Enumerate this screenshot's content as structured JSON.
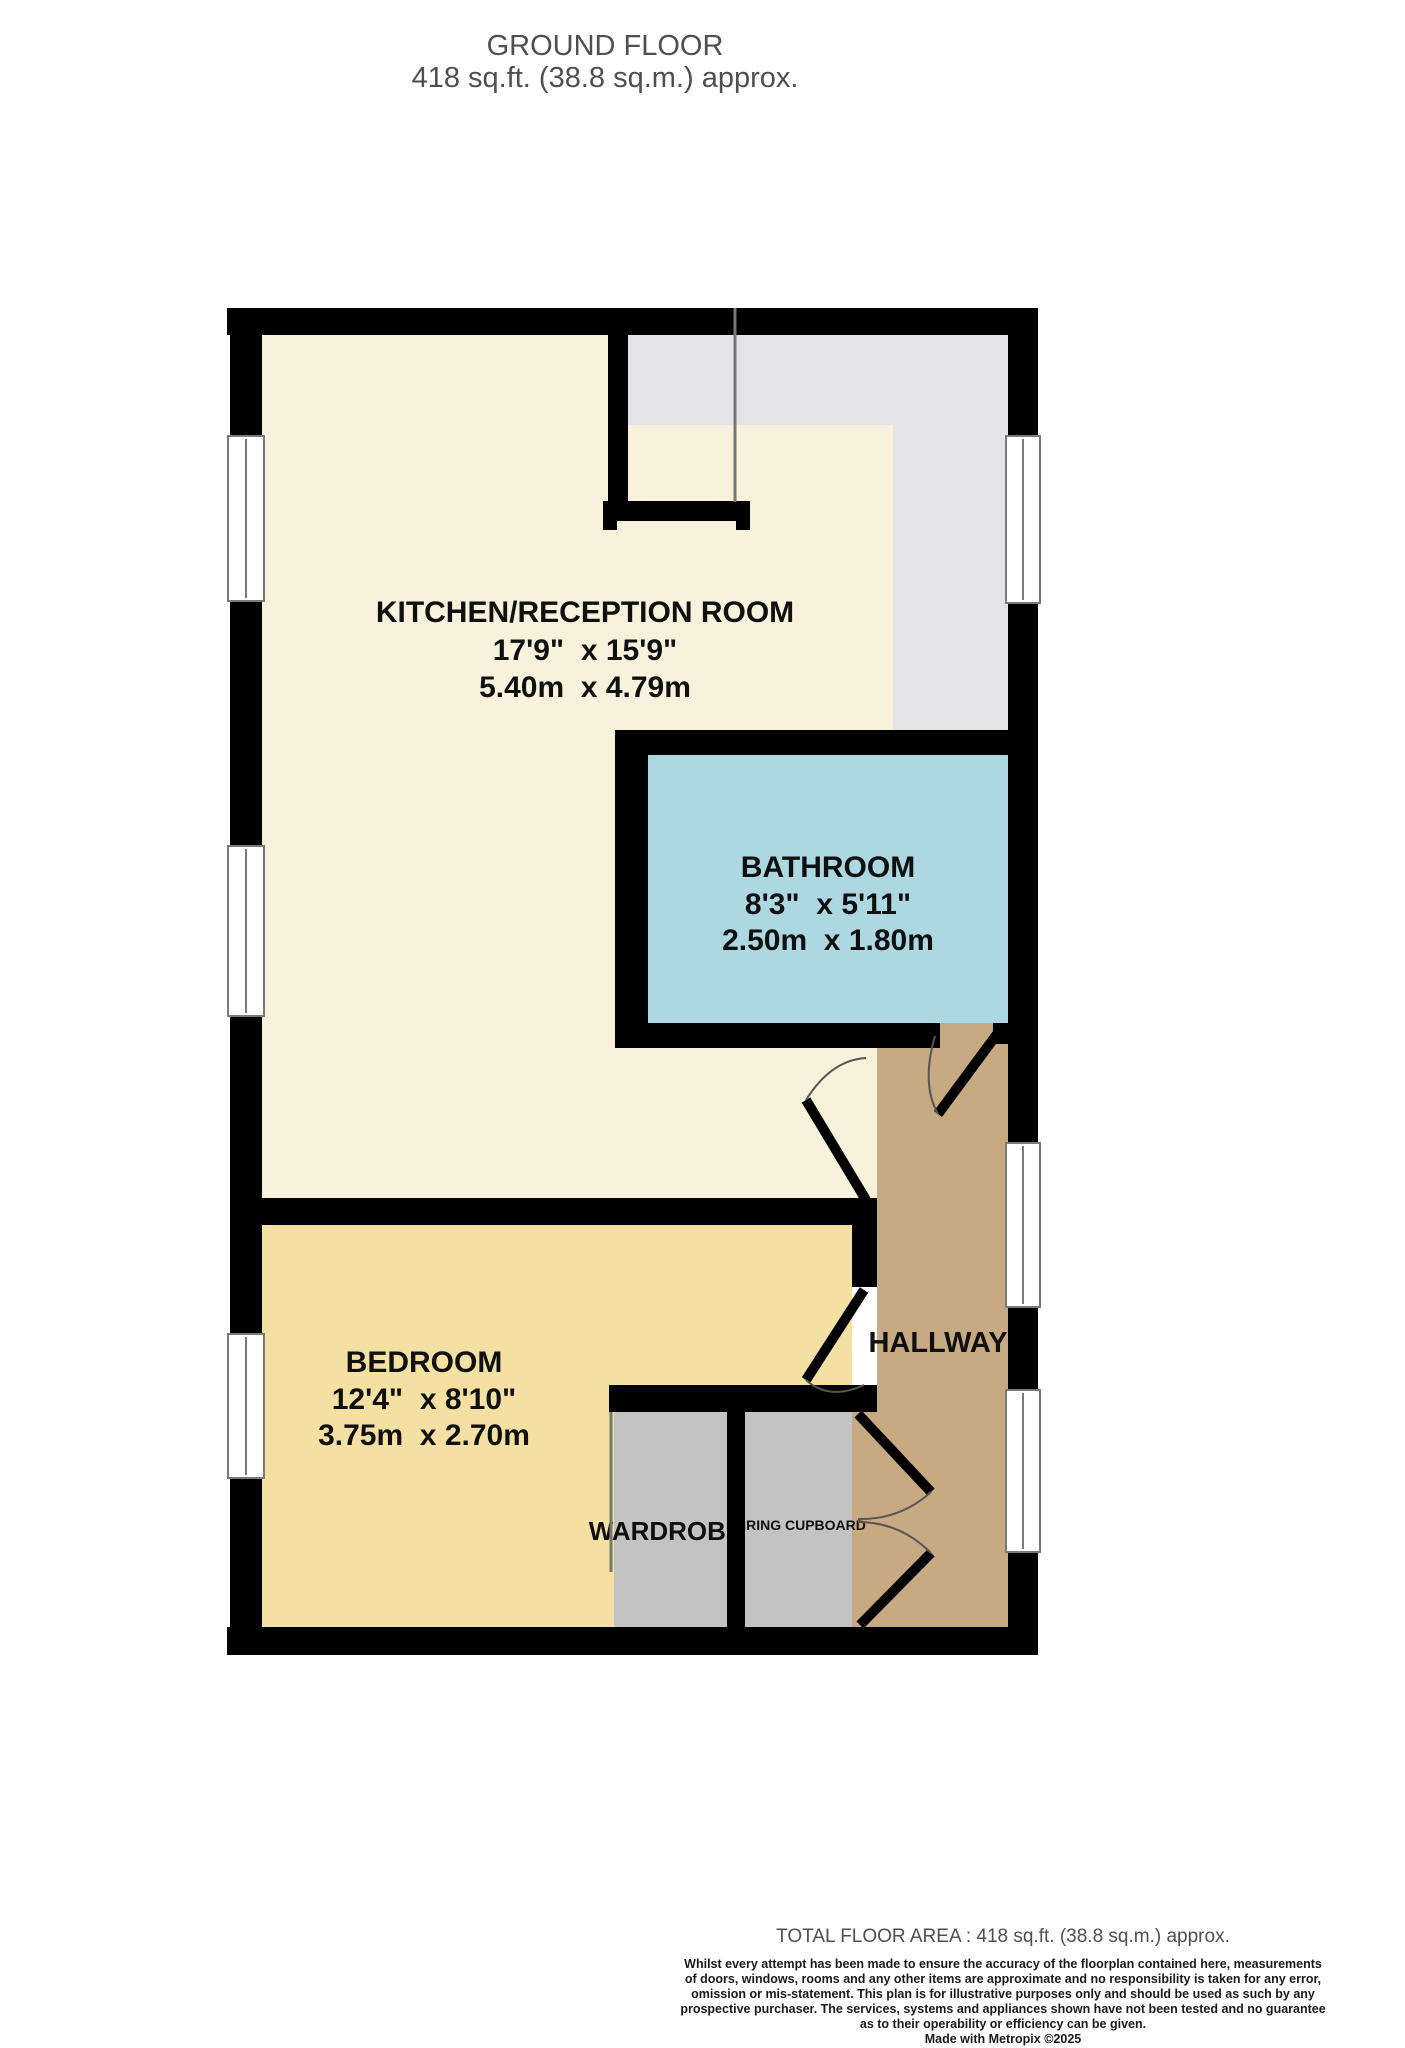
{
  "title": {
    "line1": "GROUND FLOOR",
    "line2": "418 sq.ft. (38.8 sq.m.) approx."
  },
  "rooms": {
    "kitchen": {
      "name": "KITCHEN/RECEPTION ROOM",
      "imperial": "17'9\"  x 15'9\"",
      "metric": "5.40m  x 4.79m"
    },
    "bathroom": {
      "name": "BATHROOM",
      "imperial": "8'3\"  x 5'11\"",
      "metric": "2.50m  x 1.80m"
    },
    "bedroom": {
      "name": "BEDROOM",
      "imperial": "12'4\"  x 8'10\"",
      "metric": "3.75m  x 2.70m"
    },
    "hallway": {
      "name": "HALLWAY"
    },
    "wardrobe": {
      "name": "WARDROBE"
    },
    "airing_cupboard": {
      "name": "AIRING CUPBOARD"
    }
  },
  "footer": {
    "total": "TOTAL FLOOR AREA : 418 sq.ft. (38.8 sq.m.) approx.",
    "disclaimer_lines": [
      "Whilst every attempt has been made to ensure the accuracy of the floorplan contained here, measurements",
      "of doors, windows, rooms and any other items are approximate and no responsibility is taken for any error,",
      "omission or mis-statement. This plan is for illustrative purposes only and should be used as such by any",
      "prospective purchaser. The services, systems and appliances shown have not been tested and no guarantee",
      "as to their operability or efficiency can be given."
    ],
    "credit": "Made with Metropix ©2025"
  },
  "colors": {
    "wall": "#000000",
    "window": "#ffffff",
    "kitchen": "#f8f2dc",
    "bedroom": "#f3e0a2",
    "bathroom": "#add7e1",
    "hallway": "#c8aa82",
    "landing": "#e4e4e6",
    "storage": "#c3c3c3",
    "title_text": "#4f4f4f",
    "label_text": "#101010"
  }
}
